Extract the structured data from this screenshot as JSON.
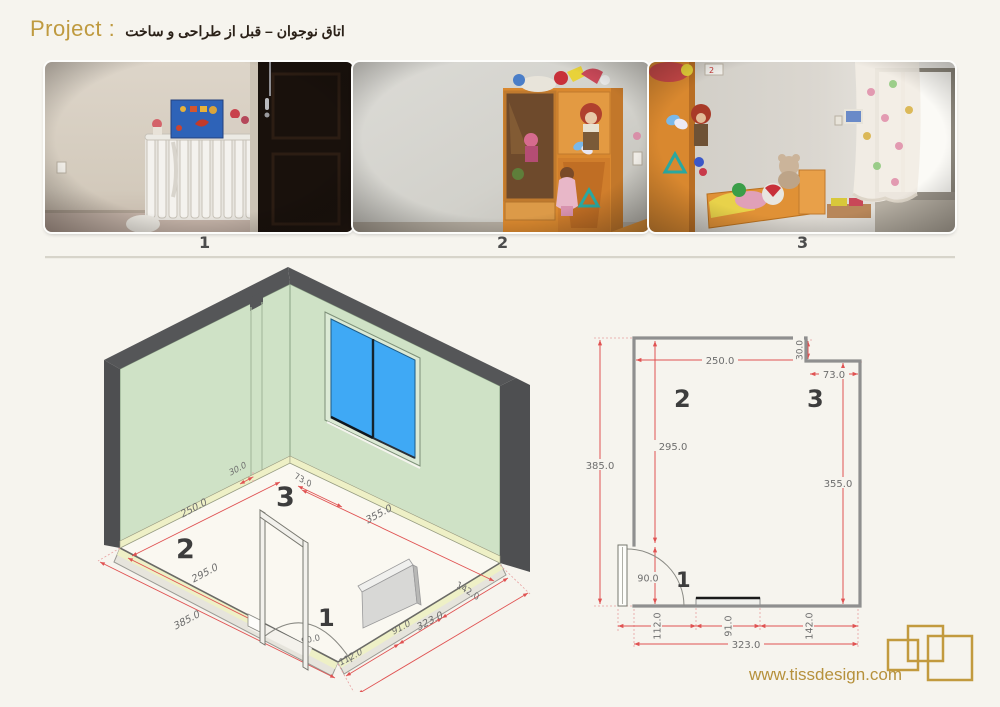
{
  "header": {
    "project_label": "Project :",
    "subtitle_fa": "اتاق نوجوان – قبل از طراحی و ساخت"
  },
  "photos": {
    "captions": [
      "1",
      "2",
      "3"
    ]
  },
  "viewpoints": {
    "v1": "1",
    "v2": "2",
    "v3": "3"
  },
  "dimensions": {
    "top_width": "250.0",
    "notch_depth": "30.0",
    "notch_width": "73.0",
    "left_interior": "295.0",
    "left_overall": "385.0",
    "right_interior": "355.0",
    "door_swing": "90.0",
    "bottom_left": "112.0",
    "radiator_width": "91.0",
    "bottom_right": "142.0",
    "bottom_overall": "323.0"
  },
  "footer": {
    "website": "www.tissdesign.com"
  },
  "colors": {
    "accent_gold": "#bb9440",
    "dim_red": "#e05252",
    "wall_green": "#cfe2c6",
    "window_blue": "#3fa9f5",
    "edge_grey": "#57585a"
  }
}
